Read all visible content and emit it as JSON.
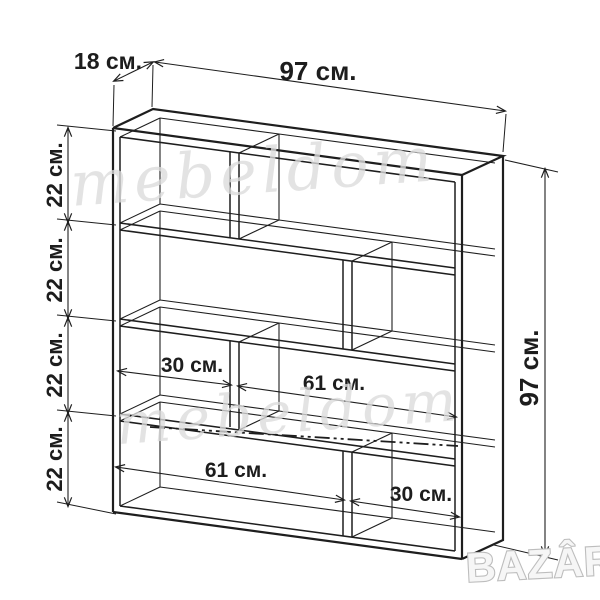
{
  "title": "Shelf unit technical drawing",
  "labels": {
    "depth": "18 см.",
    "width_top": "97 см.",
    "height_right": "97 см.",
    "row_heights": [
      "22 см.",
      "22 см.",
      "22 см.",
      "22 см."
    ],
    "row3_left_width": "30 см.",
    "row3_right_width": "61 см.",
    "row4_left_width": "61 см.",
    "row4_right_width": "30 см."
  },
  "dimensions_cm": {
    "width": 97,
    "depth": 18,
    "height": 97,
    "row_heights": [
      22,
      22,
      22,
      22
    ],
    "row3_compartments": [
      30,
      61
    ],
    "row4_compartments": [
      61,
      30
    ]
  },
  "watermarks": {
    "brand_script": "mebeldom",
    "marketplace_logo": "BAZÂR"
  },
  "colors": {
    "line": "#1e1e1e",
    "background": "#ffffff",
    "watermark_gray": "#dcdcdc",
    "label_text": "#1d1d1d"
  }
}
